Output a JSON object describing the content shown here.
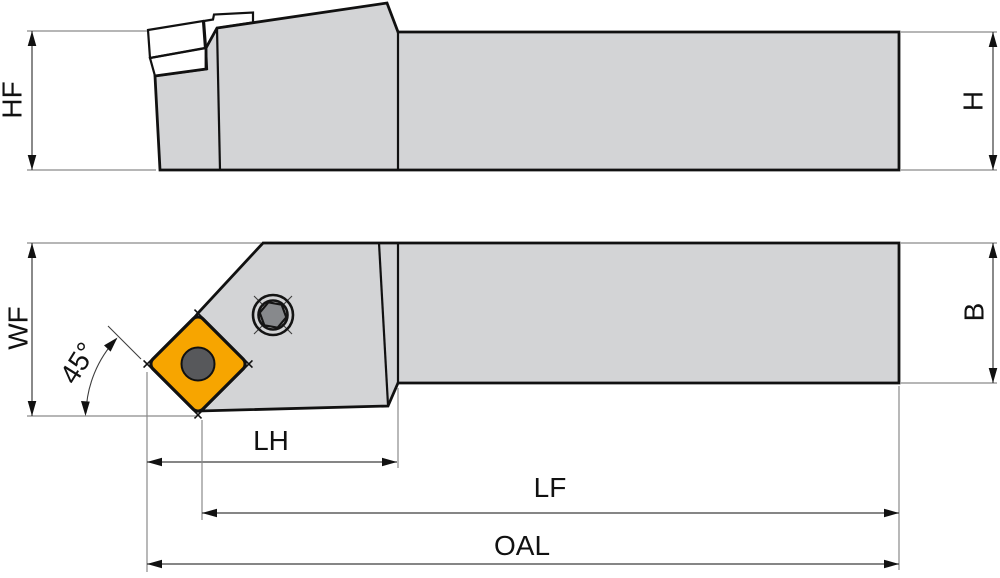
{
  "drawing": {
    "labels": {
      "hf": "HF",
      "h": "H",
      "wf": "WF",
      "b": "B",
      "lh": "LH",
      "lf": "LF",
      "oal": "OAL",
      "angle": "45°"
    },
    "colors": {
      "background": "#ffffff",
      "body": "#d3d4d6",
      "insert": "#f7a500",
      "shim": "#8e9093",
      "hole": "#57585b",
      "screw_hex": "#87898c"
    }
  }
}
